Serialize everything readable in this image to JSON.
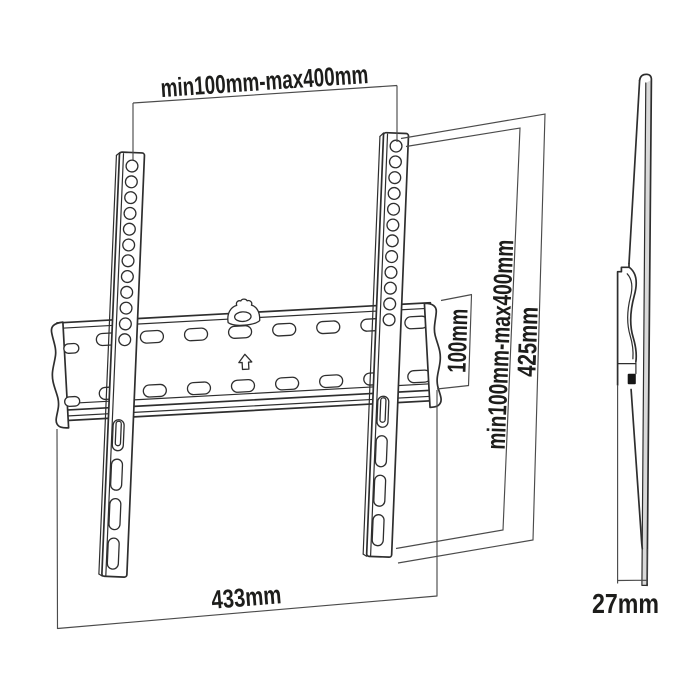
{
  "diagram": {
    "type": "technical-drawing",
    "subject": "Fixed TV wall mount bracket with dimensions, front and side views",
    "background": "#ffffff"
  },
  "colors": {
    "line": "#2e2e2e",
    "dimension_line": "#4b4b4b",
    "text": "#1d1d1b",
    "panel_fill": "#d9d9d9",
    "hook_fill": "#161616"
  },
  "labels": {
    "vesa_width": "min100mm-max400mm",
    "vesa_height": "min100mm-max400mm",
    "plate_height": "100mm",
    "bracket_height": "425mm",
    "plate_width": "433mm",
    "depth": "27mm"
  },
  "icons": {
    "plate_arrow": "up-arrow"
  }
}
